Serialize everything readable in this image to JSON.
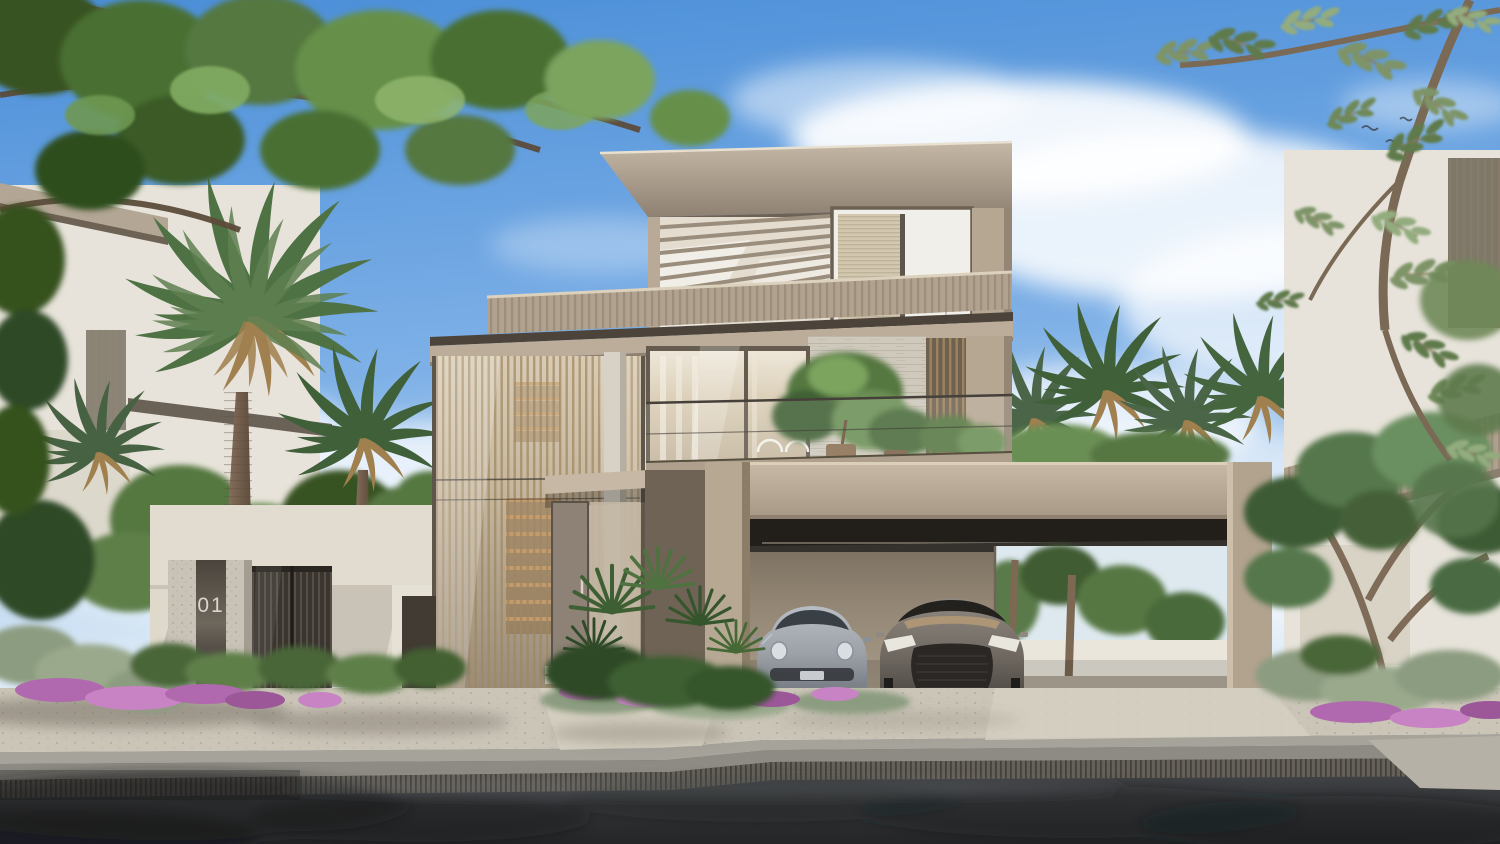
{
  "scene": {
    "alt": "Sunny photorealistic exterior rendering of a modern three-storey beige villa with glass facades, rooftop terrace with pergola, attached carport sheltering two sports cars, lush palm garden, gate pillar numbered 01, paved sidewalk and asphalt street in the foreground.",
    "house_number": "01"
  },
  "palette": {
    "sky_top": "#4A8ED8",
    "sky_mid": "#7FB1E7",
    "sky_horizon": "#DCEAF6",
    "cloud": "#FFFFFF",
    "roof_top": "#C6B8A6",
    "roof_shadow": "#6E6254",
    "roof_edge": "#E8E0D1",
    "fascia_dark": "#4C433A",
    "facade_beige": "#B6A792",
    "facade_light": "#E3DCCF",
    "parapet": "#B1A28F",
    "louver_bronze": "#A1865E",
    "glass_warm": "#D6C9B2",
    "interior_white": "#F1EFE9",
    "interior_warm": "#E5D7BF",
    "stone": "#CFC9BC",
    "concrete_light": "#D8D2C6",
    "carport_fascia": "#BDAE9B",
    "carport_wall": "#968976",
    "carport_dark": "#35322D",
    "slot_dark": "#221F1B",
    "wall_white": "#E7E3DA",
    "garden_wall": "#DFD9CC",
    "gate_metal": "#3A352F",
    "pillar": "#C8C2B7",
    "number_text": "#D9D6D0",
    "leaf_dark": "#375322",
    "leaf_mid": "#547741",
    "leaf_light": "#7CA45E",
    "olive": "#7E9468",
    "palm_green": "#4F7245",
    "palm_dark": "#40603A",
    "palm_dry": "#A0804E",
    "trunk": "#826D59",
    "flower": "#B069AE",
    "hedge_grey": "#8C9C80",
    "paver": "#CBC5B8",
    "apron": "#8E8B84",
    "grate": "#65615A",
    "road_light": "#4D5053",
    "road_dark": "#232527",
    "car_silver": "#9DA2A9",
    "car_bronze": "#6E6861"
  }
}
